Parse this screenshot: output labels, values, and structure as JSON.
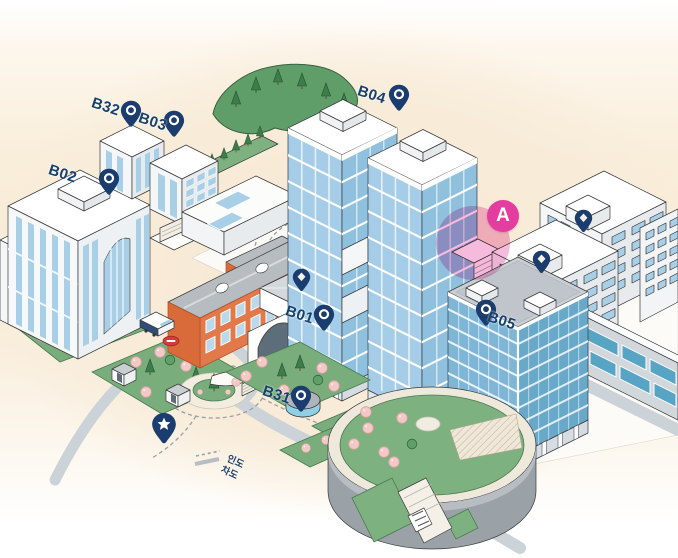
{
  "map": {
    "kind": "isometric-campus-map",
    "markers": {
      "buildings": [
        {
          "id": "b02",
          "label": "B02",
          "icon": "pin-ring"
        },
        {
          "id": "b32",
          "label": "B32",
          "icon": "pin-ring"
        },
        {
          "id": "b03",
          "label": "B03",
          "icon": "pin-ring"
        },
        {
          "id": "b04",
          "label": "B04",
          "icon": "pin-ring"
        },
        {
          "id": "b01",
          "label": "B01",
          "icon": "pin-ring"
        },
        {
          "id": "b05",
          "label": "B05",
          "icon": "pin-ring"
        },
        {
          "id": "b31",
          "label": "B31",
          "icon": "pin-ring"
        }
      ],
      "zone": {
        "label": "A"
      },
      "poi": [
        {
          "id": "courtyard-pin",
          "icon": "pin-diamond"
        },
        {
          "id": "northeast-building-pin",
          "icon": "pin-diamond"
        },
        {
          "id": "east-building-pin",
          "icon": "pin-diamond"
        },
        {
          "id": "plaza-star-pin",
          "icon": "pin-star"
        }
      ]
    },
    "legend": {
      "items": [
        {
          "id": "sidewalk",
          "label": "인도",
          "line": "dashed"
        },
        {
          "id": "roadway",
          "label": "차도",
          "line": "solid"
        }
      ]
    },
    "colors": {
      "pin_navy": "#1b3c6e",
      "label_navy": "#16406e",
      "zone_badge_magenta": "#e33da0",
      "zone_highlight_pink": "rgba(233,92,171,0.42)",
      "bus_stop_red": "#d23c3c",
      "brick_orange": "#e2794a",
      "glass_blue": "#a5cde8",
      "teal_window": "#58a4c4",
      "lawn_green": "#79ae7c",
      "hill_green": "#5f9e68",
      "road_gray": "#ccd3d8",
      "ground_peach": "#f8ebd7"
    },
    "scene_features": [
      "hill-icon",
      "tree-conifer-icon",
      "tree-blossom-icon",
      "bus-icon",
      "bus-stop-icon",
      "roundabout-icon",
      "stairs-icon",
      "rooftop-garden-icon"
    ]
  }
}
